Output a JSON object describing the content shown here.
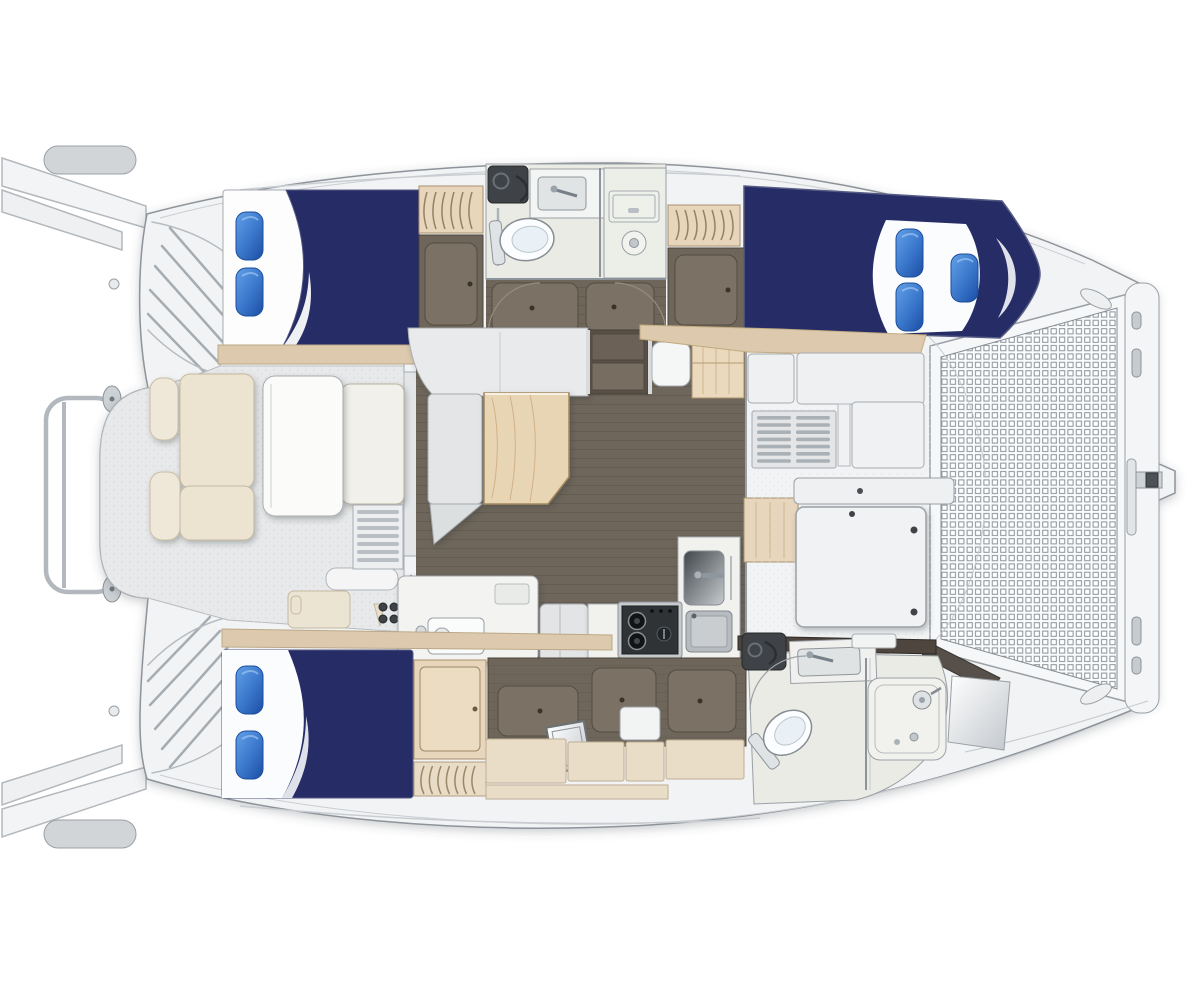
{
  "title": "Catamaran yacht interior layout plan, top-down view, bow to the right",
  "colors": {
    "page_bg": "#ffffff",
    "deck_white": "#f2f3f4",
    "outline_gray": "#8d939a",
    "bedding_navy": "#262c66",
    "bed_outline": "#565b84",
    "pillow_blue_light": "#62a0e8",
    "pillow_blue_mid": "#3b78cc",
    "pillow_blue_dark": "#1d52a8",
    "shelf_wood": "#ddcaae",
    "cabinet_wood": "#e7d6bb",
    "table_wood": "#e8d5b4",
    "floor_dark_wood": "#6f665b",
    "floor_panel": "#7b7164",
    "cushion_cream": "#ece4d1",
    "settee_gray": "#e9eaeb",
    "head_floor": "#eaebe4",
    "cockpit_floor": "#e8e9ea",
    "appliance_dark": "#3f4347",
    "stove_black": "#303336",
    "counter_white": "#f3f3f1",
    "wood_wall_dark": "#4e463e",
    "metal_gray": "#b2b8bd"
  },
  "plan": {
    "orientation": {
      "bow": "right",
      "stern": "left"
    },
    "port_hull": {
      "position": "top",
      "spaces": [
        "transom-steps",
        "aft-double-cabin",
        "wardrobe",
        "shared-head-with-shower",
        "companionway-steps",
        "wardrobe",
        "forward-double-cabin"
      ],
      "pillows": {
        "aft_cabin": 2,
        "forward_cabin": 3
      }
    },
    "starboard_hull": {
      "position": "bottom",
      "spaces": [
        "transom-steps",
        "aft-double-cabin",
        "wardrobe",
        "dresser-storage",
        "forward-head-with-shower"
      ],
      "pillows": {
        "aft_cabin": 2
      }
    },
    "bridgedeck": [
      "stern-rail",
      "cockpit-settee-and-table",
      "saloon-settee-and-table",
      "nav-station",
      "galley-with-two-burner-stove-and-sinks",
      "foredeck-lockers",
      "bow-trampoline",
      "forward-crossbeam-with-anchor-roller"
    ],
    "equipment": {
      "double_berths": 3,
      "heads": 2,
      "showers": 2,
      "stove_burners": 2,
      "galley_sinks": 2,
      "toilets": 2
    }
  }
}
